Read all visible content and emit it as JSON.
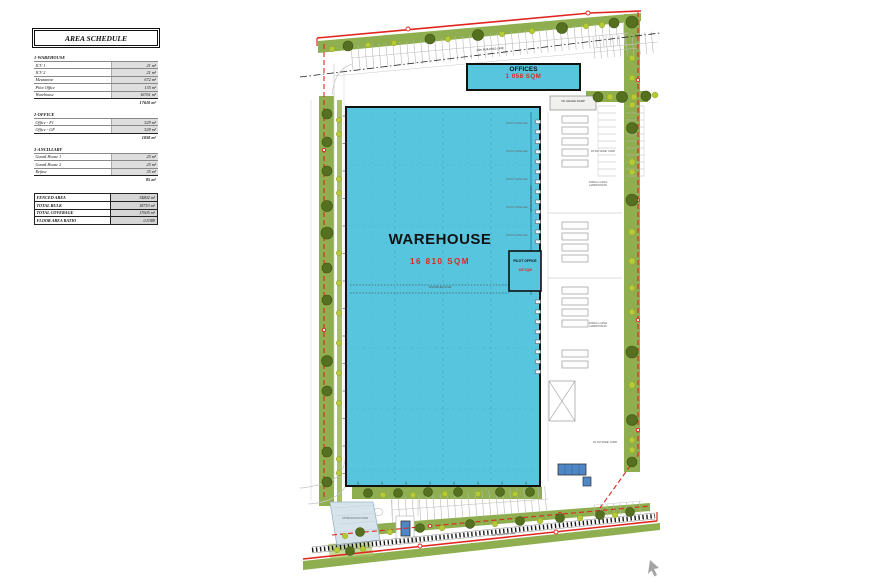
{
  "schedule": {
    "title": "AREA SCHEDULE",
    "sections": [
      {
        "name": "1-WAREHOUSE",
        "rows": [
          [
            "ICV 1",
            "21 m²"
          ],
          [
            "ICV 2",
            "21 m²"
          ],
          [
            "Mezzanine",
            "672 m²"
          ],
          [
            "Pilot Office",
            "135 m²"
          ],
          [
            "Warehouse",
            "16761 m²"
          ]
        ],
        "total": "17610 m²"
      },
      {
        "name": "2-OFFICE",
        "rows": [
          [
            "Office - F1",
            "529 m²"
          ],
          [
            "Office - GF",
            "529 m²"
          ]
        ],
        "total": "1058 m²"
      },
      {
        "name": "3-ANCILLARY",
        "rows": [
          [
            "Guard House 1",
            "25 m²"
          ],
          [
            "Guard House 2",
            "25 m²"
          ],
          [
            "Refuse",
            "35 m²"
          ]
        ],
        "total": "85 m²"
      }
    ],
    "summary": [
      [
        "FENCED AREA",
        "34802 m²"
      ],
      [
        "TOTAL BULK",
        "18753 m²"
      ],
      [
        "TOTAL COVERAGE",
        "17605 m²"
      ],
      [
        "FLOOR AREA RATIO",
        "0.5389"
      ]
    ]
  },
  "plan": {
    "warehouse": {
      "name": "WAREHOUSE",
      "area": "16 810 SQM"
    },
    "offices": {
      "name": "OFFICES",
      "area": "1 058 SQM"
    },
    "pilot_office": {
      "name": "PILOT OFFICE",
      "area": "135 SQM"
    },
    "labels": {
      "on_grade_ramp": "ON GRADE RAMP",
      "wide_yard": "45.1M WIDE YARD",
      "hardstand": "1000mm HIGH HARDSTAND",
      "building_line": "13m BUILDING LINE",
      "mezzanine": "MEZZANINE OVER",
      "dock": "DOCK LEVELLER",
      "pond": "ATTENUATION POND",
      "sprinkler": "SPRINKLER ZONE",
      "road": "8m BUILDING LINE"
    },
    "colors": {
      "building": "#58C5DE",
      "accent_red": "#E0251F",
      "green": "#8EAE4F",
      "green_light": "#A8C163",
      "tree_dark": "#55701F",
      "tree_light": "#B5CA35",
      "blue_structure": "#4F87C5"
    }
  },
  "graphics": {
    "trees_dark": [
      [
        327,
        114,
        5
      ],
      [
        327,
        142,
        5
      ],
      [
        327,
        171,
        5
      ],
      [
        327,
        206,
        5.5
      ],
      [
        327,
        233,
        6
      ],
      [
        327,
        268,
        5
      ],
      [
        327,
        300,
        5
      ],
      [
        327,
        361,
        5.5
      ],
      [
        327,
        391,
        5
      ],
      [
        327,
        452,
        5
      ],
      [
        327,
        482,
        5
      ],
      [
        632,
        22,
        6
      ],
      [
        632,
        128,
        5.5
      ],
      [
        632,
        200,
        6
      ],
      [
        632,
        352,
        6
      ],
      [
        632,
        420,
        5.5
      ],
      [
        632,
        462,
        5
      ],
      [
        348,
        46,
        5
      ],
      [
        430,
        39,
        5
      ],
      [
        478,
        35,
        5.5
      ],
      [
        562,
        28,
        5.5
      ],
      [
        614,
        23,
        5
      ],
      [
        598,
        97,
        5
      ],
      [
        622,
        97,
        5.5
      ],
      [
        646,
        96,
        5
      ],
      [
        368,
        493,
        4.5
      ],
      [
        398,
        493,
        4.5
      ],
      [
        428,
        492,
        4.5
      ],
      [
        458,
        492,
        4.5
      ],
      [
        500,
        492,
        4.5
      ],
      [
        530,
        492,
        4.5
      ],
      [
        360,
        532,
        4.5
      ],
      [
        420,
        528,
        4.5
      ],
      [
        470,
        524,
        4.5
      ],
      [
        520,
        521,
        4.5
      ],
      [
        560,
        518,
        4.5
      ],
      [
        600,
        515,
        4.5
      ],
      [
        630,
        512,
        4.5
      ],
      [
        350,
        551,
        4.5
      ]
    ],
    "trees_light": [
      [
        339,
        120,
        2.8
      ],
      [
        339,
        134,
        2.8
      ],
      [
        339,
        179,
        2.8
      ],
      [
        339,
        193,
        2.8
      ],
      [
        339,
        253,
        2.8
      ],
      [
        339,
        283,
        2.8
      ],
      [
        339,
        313,
        2.8
      ],
      [
        339,
        343,
        2.8
      ],
      [
        339,
        373,
        2.8
      ],
      [
        339,
        403,
        2.8
      ],
      [
        339,
        459,
        2.8
      ],
      [
        339,
        473,
        2.8
      ],
      [
        632,
        58,
        3
      ],
      [
        632,
        78,
        3
      ],
      [
        632,
        105,
        3
      ],
      [
        632,
        162,
        3.2
      ],
      [
        632,
        172,
        3
      ],
      [
        632,
        232,
        3.2
      ],
      [
        632,
        261,
        3.2
      ],
      [
        632,
        288,
        3
      ],
      [
        632,
        312,
        3
      ],
      [
        632,
        385,
        3.2
      ],
      [
        632,
        440,
        3
      ],
      [
        632,
        450,
        3
      ],
      [
        332,
        49,
        2.8
      ],
      [
        368,
        45,
        2.8
      ],
      [
        394,
        43,
        2.8
      ],
      [
        448,
        39,
        2.8
      ],
      [
        502,
        34,
        2.8
      ],
      [
        532,
        31,
        2.8
      ],
      [
        586,
        26,
        2.8
      ],
      [
        602,
        25,
        2.8
      ],
      [
        610,
        97,
        3
      ],
      [
        634,
        97,
        3
      ],
      [
        655,
        95,
        3
      ],
      [
        383,
        495,
        2.8
      ],
      [
        413,
        495,
        2.8
      ],
      [
        445,
        494,
        2.8
      ],
      [
        478,
        494,
        2.8
      ],
      [
        515,
        494,
        2.8
      ],
      [
        345,
        536,
        2.8
      ],
      [
        390,
        532,
        2.8
      ],
      [
        442,
        528,
        2.8
      ],
      [
        495,
        524,
        2.8
      ],
      [
        540,
        521,
        2.8
      ],
      [
        580,
        518,
        2.8
      ],
      [
        615,
        515,
        2.8
      ],
      [
        337,
        550,
        2.8
      ],
      [
        363,
        549,
        2.8
      ]
    ],
    "stall_rows": [
      [
        352,
        58,
        628,
        33,
        12,
        7
      ],
      [
        352,
        58,
        628,
        33,
        -12,
        7
      ],
      [
        594,
        48,
        658,
        42,
        11,
        6.5
      ],
      [
        594,
        48,
        658,
        42,
        -11,
        6.5
      ],
      [
        598,
        106,
        598,
        176,
        18,
        7
      ],
      [
        644,
        106,
        644,
        176,
        -18,
        7
      ],
      [
        392,
        510,
        548,
        499,
        13,
        7
      ],
      [
        392,
        510,
        548,
        499,
        -13,
        7
      ],
      [
        594,
        505,
        642,
        501,
        -12,
        6.5
      ]
    ],
    "bays": {
      "x": 562,
      "w": 26,
      "h": 7,
      "ys": [
        116,
        127,
        138,
        149,
        160,
        222,
        233,
        244,
        255,
        287,
        298,
        309,
        320,
        350,
        361
      ]
    },
    "docks": {
      "x": 535.5,
      "w": 5,
      "h": 3.5,
      "ys": [
        120,
        130,
        140,
        150,
        160,
        170,
        180,
        190,
        200,
        210,
        220,
        230,
        240,
        300,
        310,
        320,
        330,
        340,
        350,
        360,
        370
      ]
    },
    "dock_labels": {
      "x": 517,
      "ys": [
        124,
        152,
        180,
        208,
        236
      ]
    },
    "ticks": [
      [
        "v",
        344.5,
        116,
        480,
        27.5
      ],
      [
        "h",
        484,
        358,
        534,
        24
      ]
    ]
  }
}
